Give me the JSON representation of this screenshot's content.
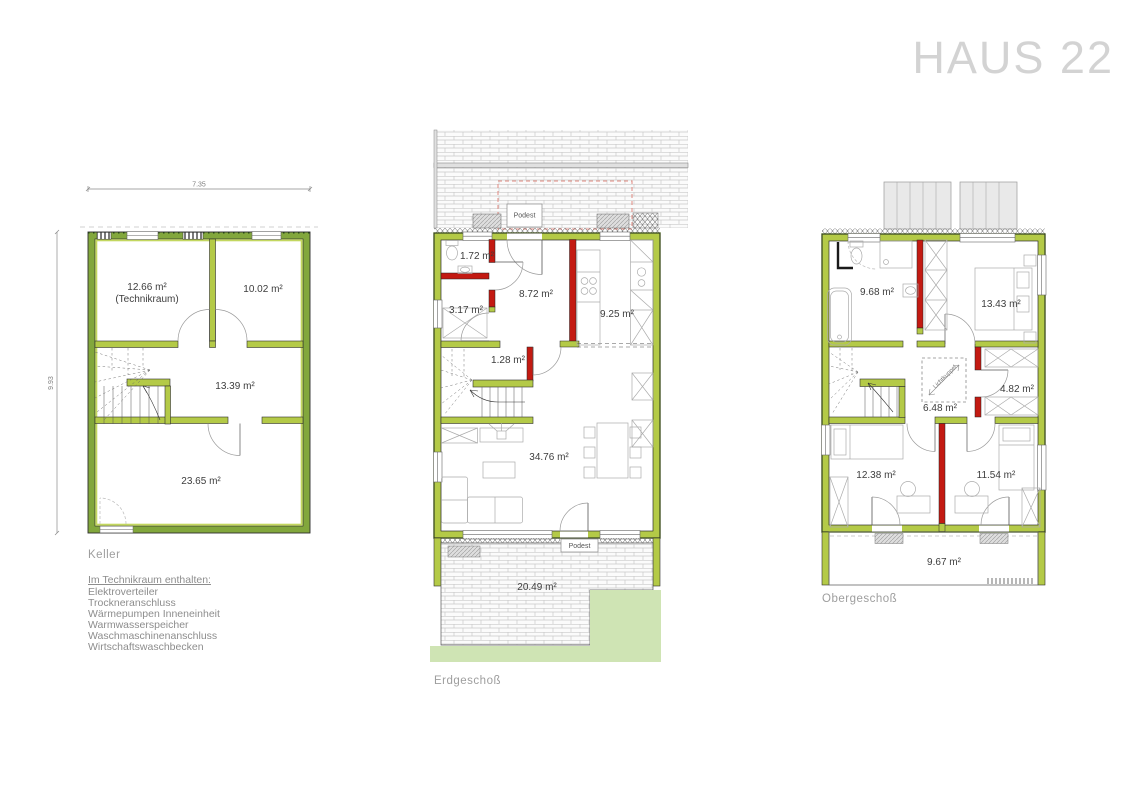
{
  "title": "HAUS 22",
  "keller": {
    "label": "Keller",
    "dim_top": "7.35",
    "dim_left": "9.93",
    "room_technik_line1": "12.66 m²",
    "room_technik_line2": "(Technikraum)",
    "room_1002": "10.02 m²",
    "room_1339": "13.39 m²",
    "room_2365": "23.65 m²"
  },
  "note": {
    "heading": "Im Technikraum enthalten:",
    "items": [
      "Elektroverteiler",
      "Trockneranschluss",
      "Wärmepumpen Inneneinheit",
      "Warmwasserspeicher",
      "Waschmaschinenanschluss",
      "Wirtschaftswaschbecken"
    ]
  },
  "erdgeschoss": {
    "label": "Erdgeschoß",
    "podest_top": "Podest",
    "podest_bottom": "Podest",
    "room_wc": "1.72 m²",
    "room_flur": "8.72 m²",
    "room_abstell": "3.17 m²",
    "room_kueche": "9.25 m²",
    "room_treppe": "1.28 m²",
    "room_wohnen": "34.76 m²",
    "room_terrasse": "20.49 m²"
  },
  "obergeschoss": {
    "label": "Obergeschoß",
    "room_bad": "9.68 m²",
    "room_schlafen": "13.43 m²",
    "room_flur": "6.48 m²",
    "room_abstell": "4.82 m²",
    "room_kind1": "12.38 m²",
    "room_kind2": "11.54 m²",
    "room_balkon": "9.67 m²",
    "lichtkuppel": "Lichtkuppel"
  },
  "colors": {
    "wall_green": "#b4ca47",
    "wall_green_dark": "#5e7d21",
    "keller_wall": "#82a73c",
    "keller_lining": "#c3d75f",
    "wall_red": "#c31a12",
    "lawn": "#cfe4b4",
    "title_gray": "#d3d3d3",
    "label_gray": "#9e9e9e"
  }
}
